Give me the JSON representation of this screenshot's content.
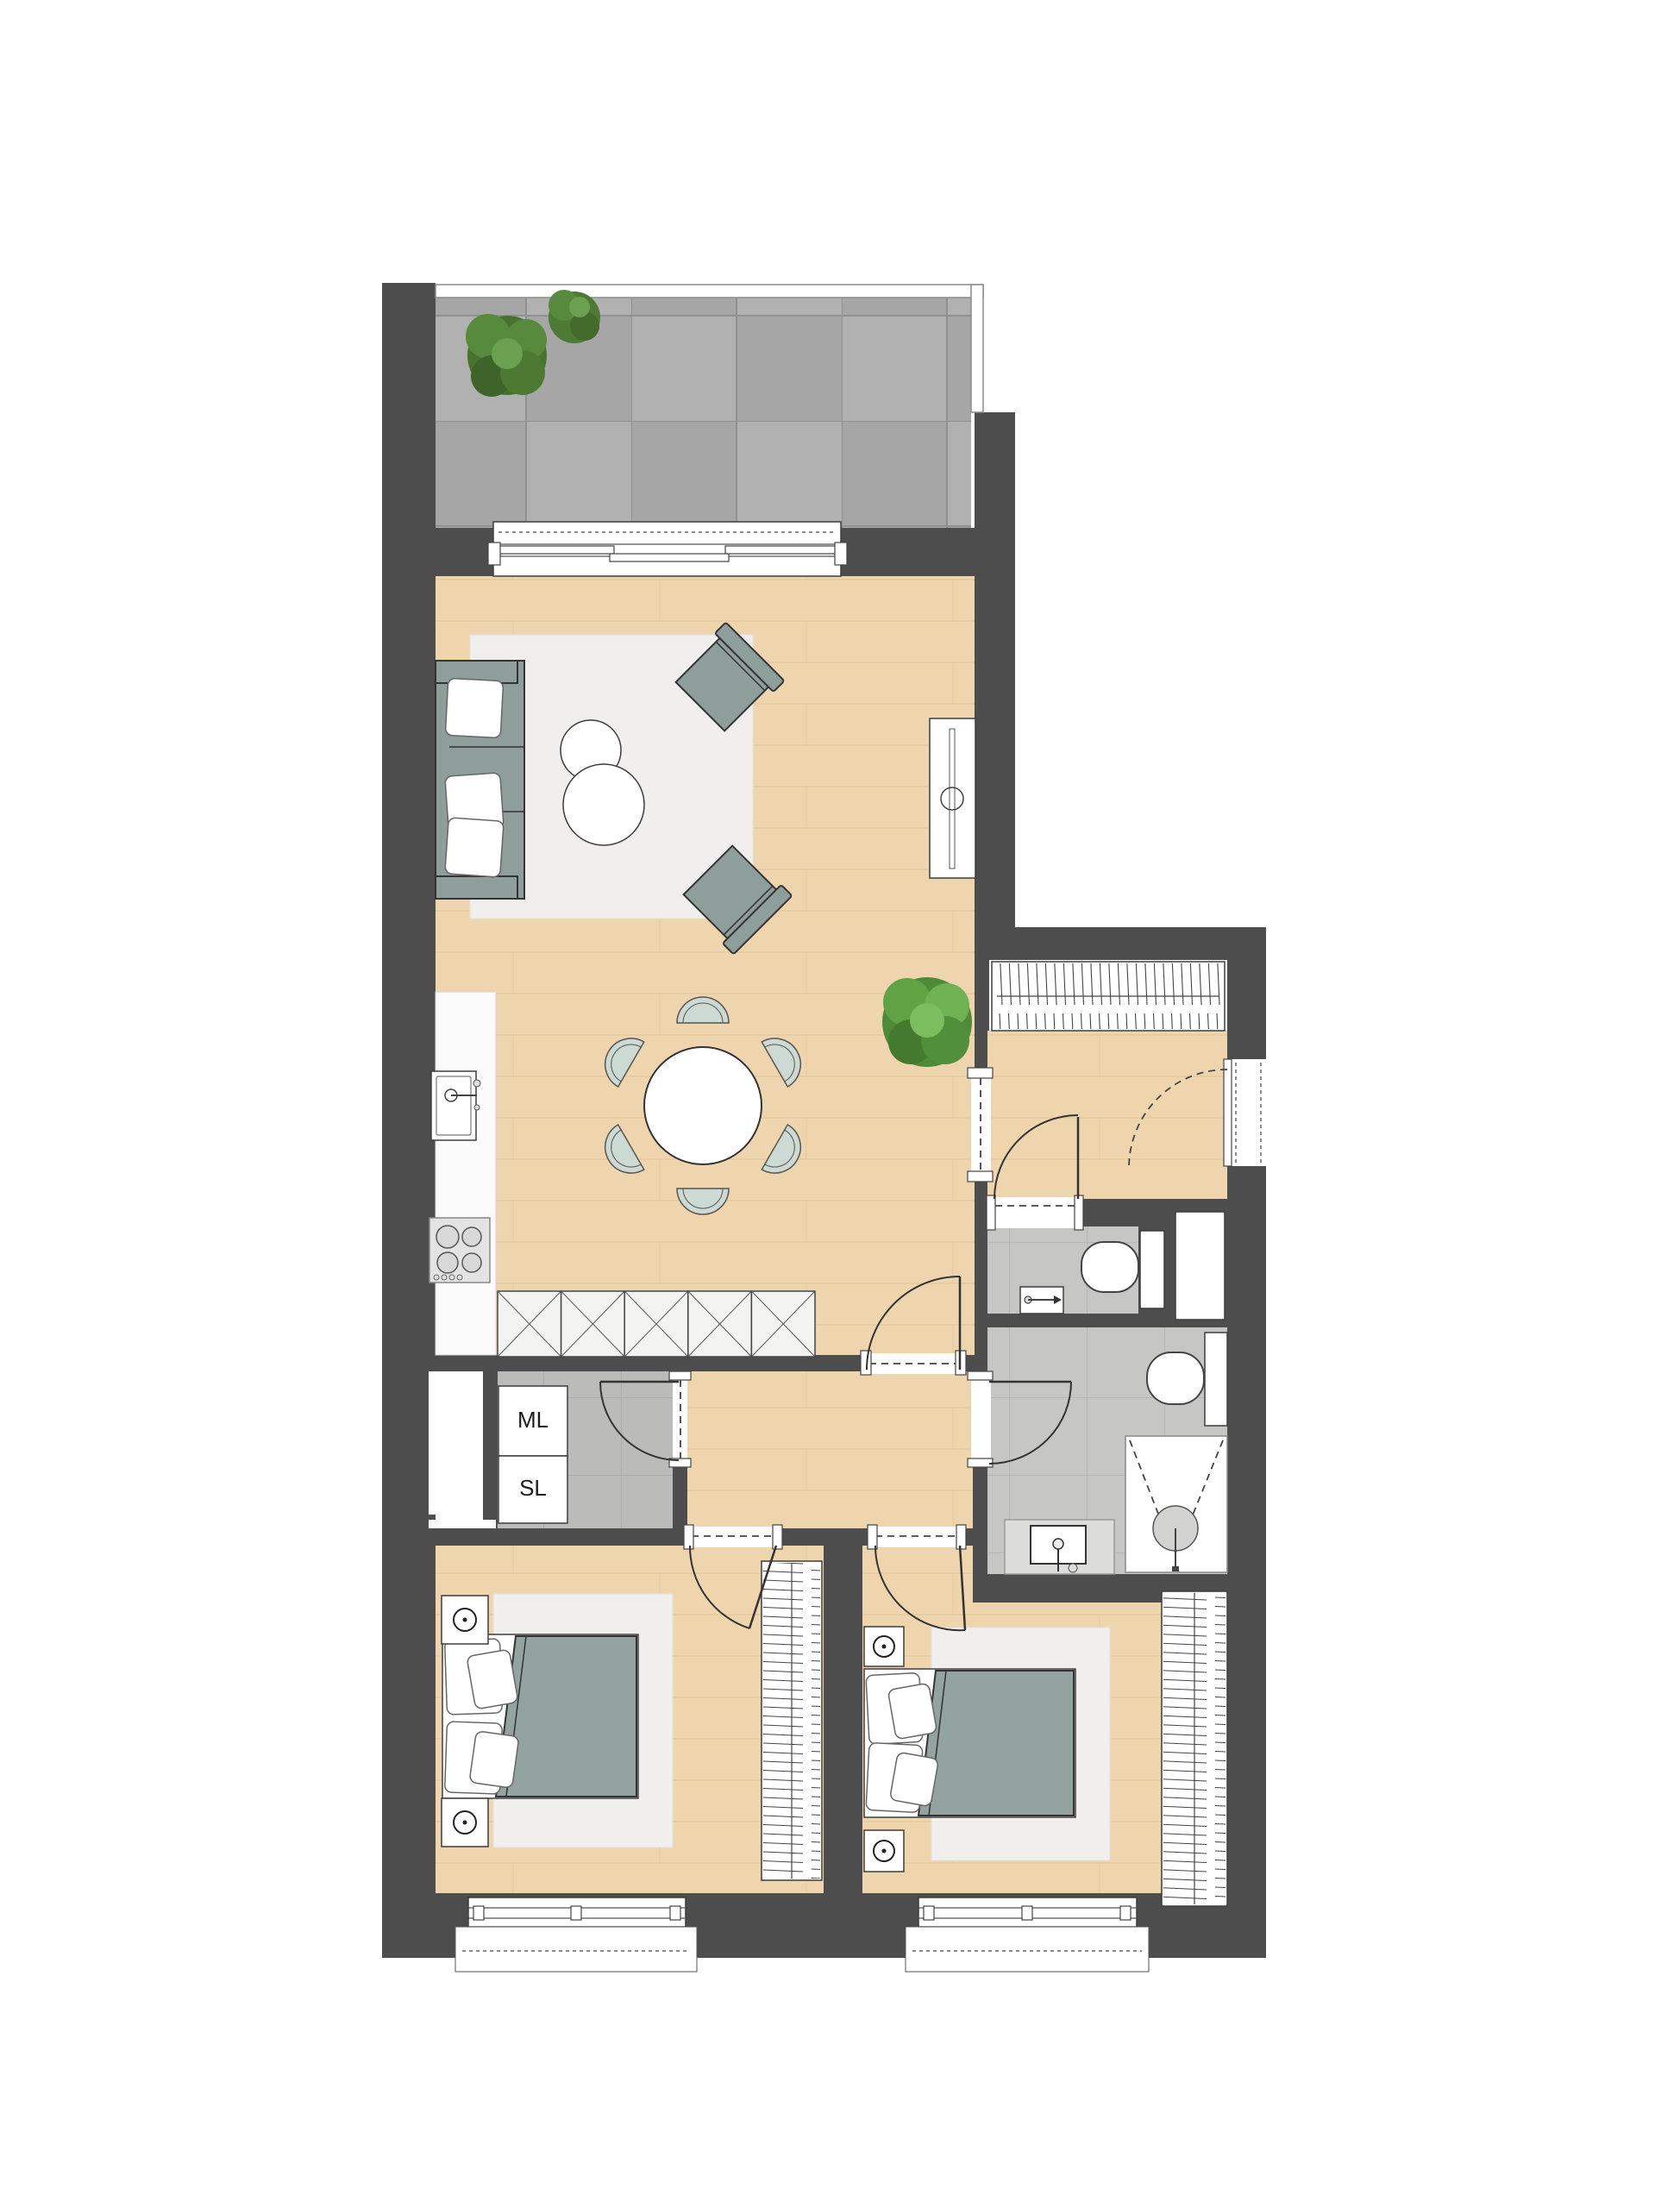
{
  "plan": {
    "labels": {
      "washing_machine": "ML",
      "dryer": "SL"
    }
  },
  "colors": {
    "wall": "#4d4d4d",
    "wood": "#eed5ad",
    "woodline": "#ddbb8e",
    "terrace": "#ababab",
    "tile": "#c6c6c4",
    "rug": "#f0efed",
    "sage": "#8e9e9a",
    "chair": "#cdd9d3",
    "blanket": "#93a39f",
    "outline": "#333333",
    "plantdark": "#49722f",
    "plantmid": "#578a3c",
    "plantlight": "#6aa04f"
  }
}
